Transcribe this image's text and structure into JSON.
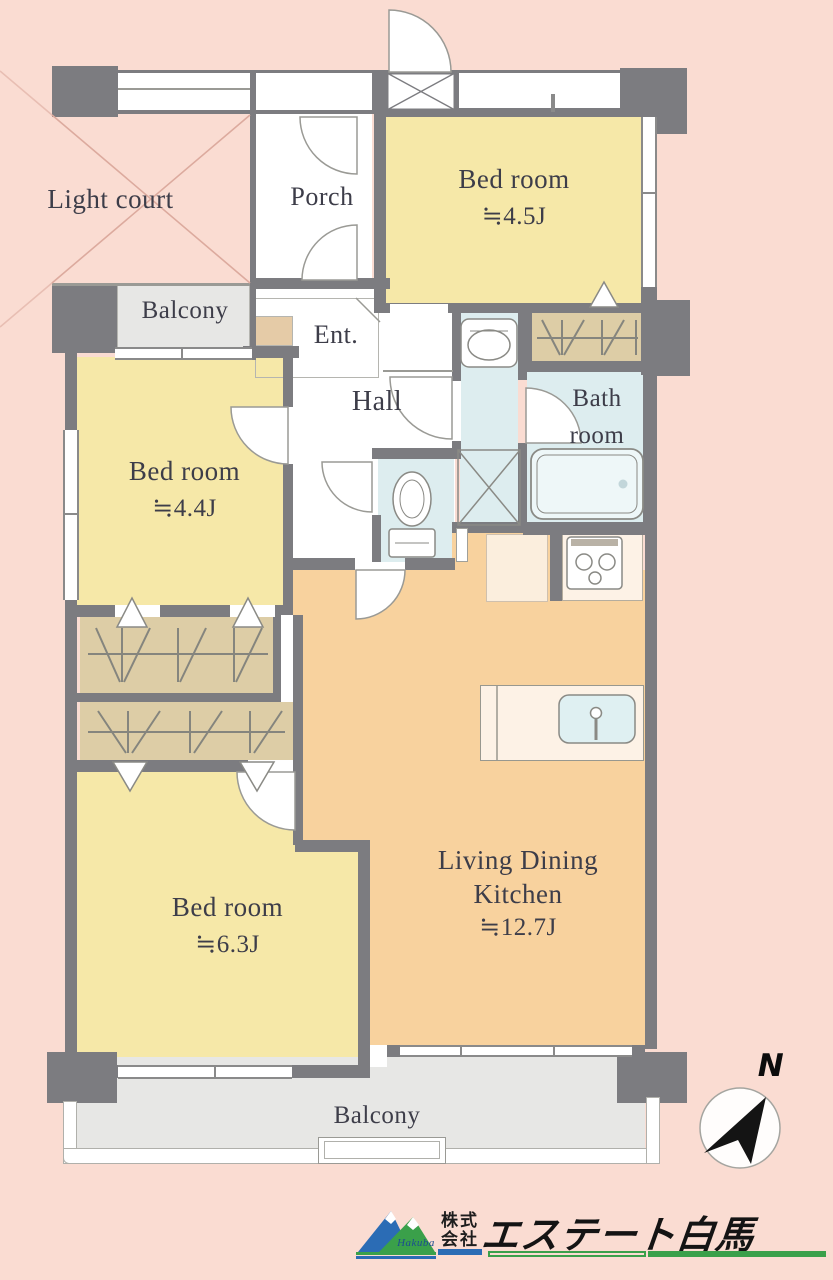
{
  "floor_plan": {
    "rooms": {
      "light_court": {
        "label": "Light court"
      },
      "porch": {
        "label": "Porch"
      },
      "entrance": {
        "label": "Ent."
      },
      "hall": {
        "label": "Hall"
      },
      "bathroom": {
        "line1": "Bath",
        "line2": "room"
      },
      "bedroom_top": {
        "label": "Bed room",
        "size": "≒4.5J"
      },
      "bedroom_left": {
        "label": "Bed room",
        "size": "≒4.4J"
      },
      "bedroom_bottom": {
        "label": "Bed room",
        "size": "≒6.3J"
      },
      "ldk": {
        "line1": "Living Dining",
        "line2": "Kitchen",
        "size": "≒12.7J"
      },
      "balcony_left": {
        "label": "Balcony"
      },
      "balcony_bottom": {
        "label": "Balcony"
      }
    },
    "compass": {
      "north_label": "N"
    },
    "colors": {
      "background": "#fadcd2",
      "wall": "#7c7c80",
      "bedroom_fill": "#f6e8a8",
      "ldk_fill": "#f8d29e",
      "wet_area_fill": "#ddedef",
      "entrance_fill": "#e5cba7",
      "closet_fill": "#ddcda6",
      "balcony_fill": "#e7e7e5",
      "label_text": "#3d3d49",
      "light_court_line": "#dcaa9e"
    }
  },
  "logo": {
    "mountain_script": "Hakuba",
    "company_type_line1": "株式",
    "company_type_line2": "会社",
    "company_name": "エステート白馬",
    "blue": "#2b6cb5",
    "green": "#3aa04a"
  }
}
